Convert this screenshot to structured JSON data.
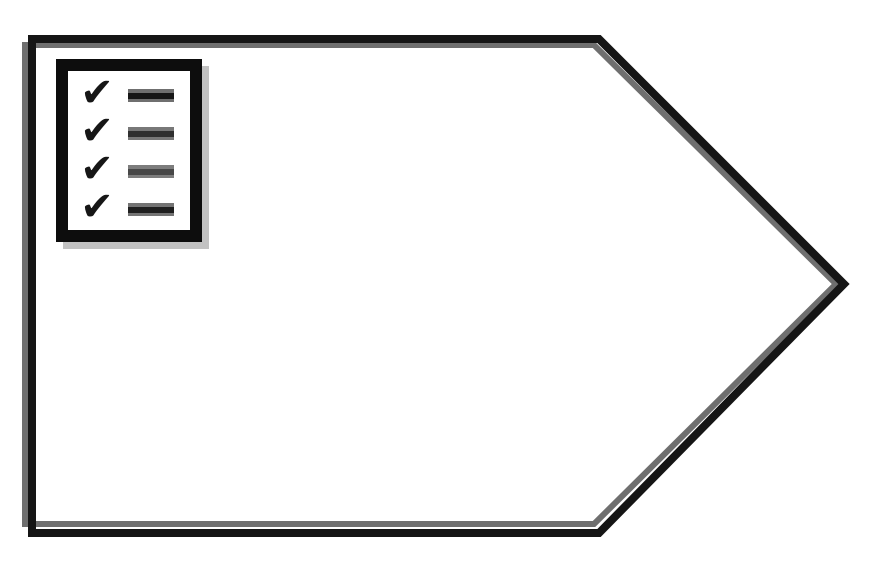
{
  "canvas": {
    "background": "#ffffff"
  },
  "diagram": {
    "shape": {
      "type": "pentagon-right-arrow",
      "fill": "#ffffff",
      "stroke_color": "#151515",
      "stroke_width": "8",
      "points": "32,39 599,39 844,284 599,533 32,533",
      "echo_color": "#6f6f6f",
      "echo_width": "6",
      "echo_points": "25,45 594,45 836,284 594,524 25,524"
    },
    "checklist_icon": {
      "border_color": "#0d0d0d",
      "paper_color": "#ffffff",
      "shadow_color": "#c2c2c2",
      "check_glyph": "✔",
      "check_color": "#161616",
      "rows": [
        {
          "dash_core": "#161616",
          "dash_edge": "#6f6f6f"
        },
        {
          "dash_core": "#2f2f2f",
          "dash_edge": "#787878"
        },
        {
          "dash_core": "#474747",
          "dash_edge": "#7d7d7d"
        },
        {
          "dash_core": "#1f1f1f",
          "dash_edge": "#747474"
        }
      ]
    }
  }
}
